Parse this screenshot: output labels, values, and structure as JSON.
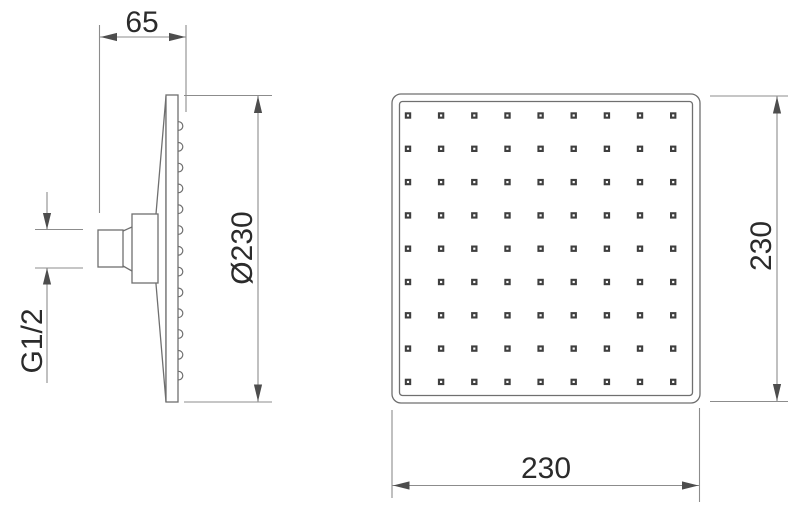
{
  "side_view": {
    "width_label": "65",
    "diameter_label": "Ø230",
    "thread_label": "G1/2",
    "nozzle_bump_count": 13
  },
  "front_view": {
    "height_label": "230",
    "width_label": "230",
    "nozzle_grid": {
      "rows": 9,
      "cols": 9
    }
  },
  "colors": {
    "background": "#ffffff",
    "object_line": "#6f6f6f",
    "dimension_line": "#8c8c8c",
    "arrow": "#4d4d4d",
    "text": "#2b2b2b",
    "nozzle_dark": "#3f3f3f",
    "nozzle_dot": "#ffffff"
  }
}
